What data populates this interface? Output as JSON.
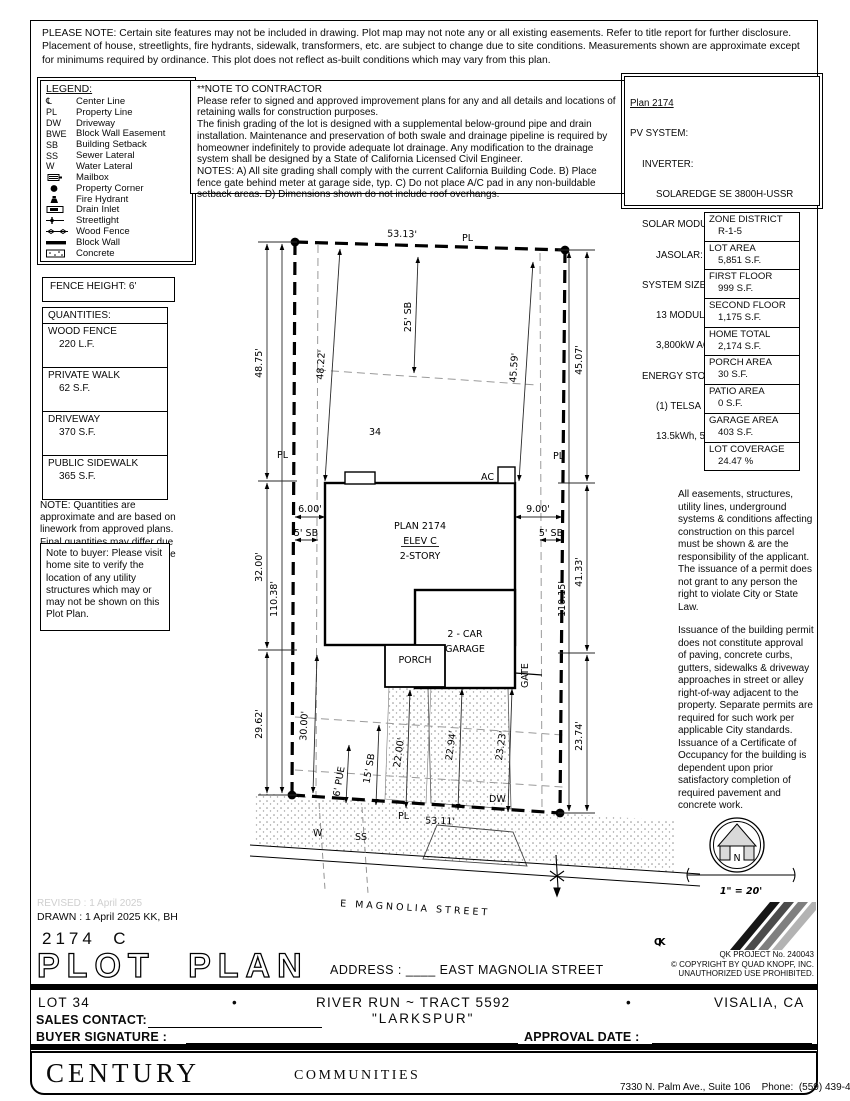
{
  "page": {
    "ink": "#000000",
    "paper": "#ffffff"
  },
  "top_note": "PLEASE NOTE:  Certain site features may not be included in drawing.  Plot map may not note any or all existing easements.  Refer to title report for further disclosure.  Placement of house, streetlights, fire hydrants, sidewalk, transformers, etc. are subject to change due to site conditions.  Measurements shown are approximate except for minimums required by ordinance.  This plot does not reflect as-built conditions which may vary from this plan.",
  "legend": {
    "title": "LEGEND:",
    "items": [
      {
        "symbol": "℄",
        "label": "Center Line"
      },
      {
        "symbol": "PL",
        "label": "Property Line"
      },
      {
        "symbol": "DW",
        "label": "Driveway"
      },
      {
        "symbol": "BWE",
        "label": "Block Wall Easement"
      },
      {
        "symbol": "SB",
        "label": "Building Setback"
      },
      {
        "symbol": "SS",
        "label": "Sewer Lateral"
      },
      {
        "symbol": "W",
        "label": "Water Lateral"
      },
      {
        "symbol": "",
        "label": "Mailbox"
      },
      {
        "symbol": "",
        "label": "Property Corner"
      },
      {
        "symbol": "",
        "label": "Fire Hydrant"
      },
      {
        "symbol": "",
        "label": "Drain Inlet"
      },
      {
        "symbol": "",
        "label": "Streetlight"
      },
      {
        "symbol": "",
        "label": "Wood Fence"
      },
      {
        "symbol": "",
        "label": "Block Wall"
      },
      {
        "symbol": "",
        "label": "Concrete"
      }
    ]
  },
  "contractor_note": {
    "line1": "**NOTE TO CONTRACTOR",
    "line2": "Please refer to signed and approved improvement plans for any and all details and locations of retaining walls for construction purposes.",
    "line3": "The finish grading of the lot is designed with a supplemental below-ground pipe and drain installation.  Maintenance and preservation of both swale and drainage pipeline is required by homeowner indefinitely to provide adequate lot drainage.  Any modification to the drainage system shall be designed by a State of California Licensed Civil Engineer.",
    "line4": "NOTES:  A) All site grading shall comply with the current California Building Code.  B) Place fence gate behind meter at garage side, typ.  C) Do not place A/C pad in any non-buildable setback areas.  D) Dimensions shown do not include roof overhangs."
  },
  "pv": {
    "lines": [
      "Plan 2174",
      "PV SYSTEM:",
      "INVERTER:",
      "SOLAREDGE SE 3800H-USSR",
      "SOLAR MODULE TYPE:",
      "JASOLAR: JAM54S31-405/MR",
      "SYSTEM SIZE:",
      "13 MODULES 4.86Kw DC/",
      "3,800kW AC (405w)",
      "ENERGY STORAGE SYSTEM:",
      "(1) TELSA POWERWALL 2,",
      "13.5kWh, 5kW"
    ]
  },
  "zone_table": {
    "rows": [
      {
        "label": "ZONE DISTRICT",
        "value": "R-1-5"
      },
      {
        "label": "LOT AREA",
        "value": "5,851 S.F."
      },
      {
        "label": "FIRST FLOOR",
        "value": "999 S.F."
      },
      {
        "label": "SECOND FLOOR",
        "value": "1,175 S.F."
      },
      {
        "label": "HOME TOTAL",
        "value": "2,174 S.F."
      },
      {
        "label": "PORCH AREA",
        "value": "30 S.F."
      },
      {
        "label": "PATIO AREA",
        "value": "0 S.F."
      },
      {
        "label": "GARAGE AREA",
        "value": "403 S.F."
      },
      {
        "label": "LOT COVERAGE",
        "value": "24.47 %"
      }
    ]
  },
  "fence_note": "FENCE HEIGHT: 6'",
  "quantities": {
    "title": "QUANTITIES:",
    "rows": [
      {
        "label": "WOOD FENCE",
        "value": "220 L.F."
      },
      {
        "label": "PRIVATE WALK",
        "value": "62 S.F."
      },
      {
        "label": "DRIVEWAY",
        "value": "370 S.F."
      },
      {
        "label": "PUBLIC SIDEWALK",
        "value": "365 S.F."
      }
    ],
    "note": "NOTE: Quantities are approximate and are based on linework from approved plans.  Final quantities may differ due to field adjustments at the time of construction."
  },
  "buyer_note": "Note to buyer: Please visit home site to verify the location of any utility structures which may or may not be shown on this Plot Plan.",
  "easement_notes": {
    "p1": "All easements, structures, utility lines, underground systems & conditions affecting construction on this parcel must be shown & are the responsibility of the applicant. The issuance of a permit does not grant to any person the right to violate City or State Law.",
    "p2": "Issuance of the building permit does not constitute approval of paving, concrete curbs, gutters, sidewalks & driveway approaches in street or alley right-of-way adjacent to the property. Separate permits are required for such work per applicable City standards. Issuance of a Certificate of Occupancy for the building is dependent upon prior satisfactory completion of required pavement and concrete work."
  },
  "plot": {
    "lot_number": "34",
    "pl_label": "PL",
    "top_length": "53.13'",
    "bottom_length": "53.11'",
    "dim_left_1": "48.75'",
    "dim_left_2": "32.00'",
    "dim_left_3": "29.62'",
    "dim_left_depth": "110.38'",
    "dim_right_1": "45.07'",
    "dim_right_2": "41.33'",
    "dim_right_3": "23.74'",
    "dim_right_depth": "110.15'",
    "dim_envelope_left": "48.22'",
    "dim_envelope_right": "45.59'",
    "rear_setback": "25' SB",
    "left_offset": "6.00'",
    "left_sb": "5' SB",
    "right_offset": "9.00'",
    "right_sb": "5' SB",
    "house_line1": "PLAN 2174",
    "house_line2": "ELEV C",
    "house_line3": "2-STORY",
    "garage_line1": "2 - CAR",
    "garage_line2": "GARAGE",
    "porch": "PORCH",
    "gate": "GATE",
    "ac": "AC",
    "dw": "DW",
    "dim_front_1": "30.00'",
    "dim_front_2": "6' PUE",
    "dim_front_3": "15' SB",
    "dim_front_4": "22.00'",
    "dim_front_5": "22.94'",
    "dim_front_6": "23.23'",
    "water": "W",
    "sewer": "SS",
    "street_name": "E MAGNOLIA STREET"
  },
  "compass": {
    "north": "N",
    "scale": "1\" = 20'"
  },
  "title_block": {
    "revised": "REVISED :  1 April 2025",
    "drawn": "DRAWN :  1 April 2025  KK, BH",
    "plan_code": "2174  C",
    "title": "PLOT PLAN",
    "address_label": "ADDRESS :",
    "address_value": "____ EAST MAGNOLIA STREET"
  },
  "qk": {
    "logo": "QK",
    "project": "QK PROJECT No. 240043",
    "copyright": "©  COPYRIGHT BY QUAD KNOPF, INC.",
    "notice": "UNAUTHORIZED USE PROHIBITED."
  },
  "footer": {
    "lot": "LOT 34",
    "bullet": "•",
    "tract": "RIVER RUN ~ TRACT 5592",
    "plan_name": "\"LARKSPUR\"",
    "city": "VISALIA, CA",
    "sales_label": "SALES CONTACT:",
    "signature_label": "BUYER SIGNATURE :",
    "approval_label": "APPROVAL DATE :"
  },
  "brand": {
    "name": "CENTURY",
    "suffix": "COMMUNITIES",
    "address_line1": "7330 N. Palm Ave., Suite 106    Phone:  (559) 439-4464",
    "address_line2": "Fresno, CA  93711"
  }
}
